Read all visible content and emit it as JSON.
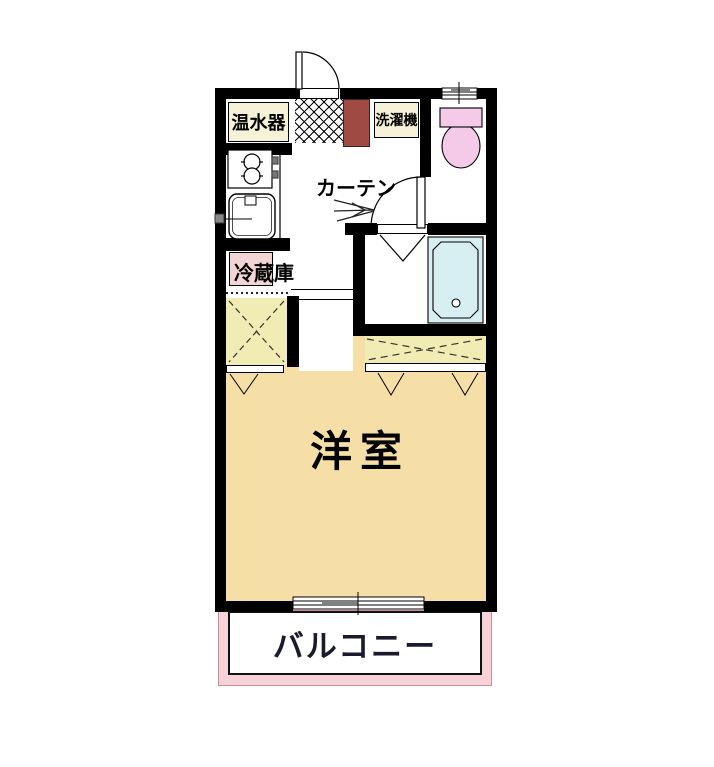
{
  "floor_plan": {
    "rooms": {
      "main_room_label": "洋室",
      "balcony_label": "バルコニー"
    },
    "annotations": {
      "water_heater": "温水器",
      "washing_machine": "洗濯機",
      "refrigerator": "冷蔵庫",
      "curtain": "カーテン"
    },
    "colors": {
      "wall": "#000000",
      "main_room_floor": "#F6DFA7",
      "closet_fill": "#F1EBB4",
      "label_box_fill": "#F5F2D8",
      "refrigerator_box_fill": "#F3D4D4",
      "toilet_fill": "#F5CAE9",
      "bathtub_fill": "#D7EEF2",
      "balcony_band_fill": "#F7D2D6",
      "entrance_cabinet_fill": "#A04A44"
    }
  }
}
